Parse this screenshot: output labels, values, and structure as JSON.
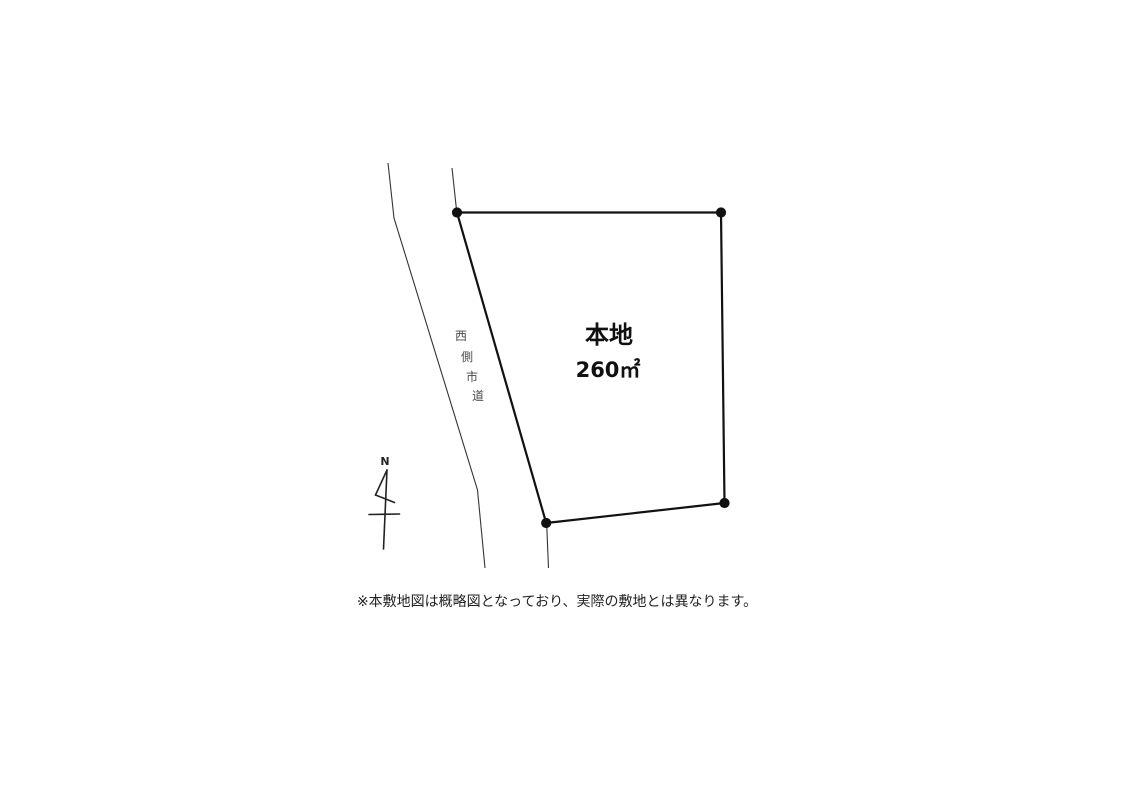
{
  "canvas": {
    "width": 1124,
    "height": 793,
    "background": "#ffffff"
  },
  "plot": {
    "label": "本地",
    "area": "260㎡",
    "polygon_points": "457,212.5 721,212.5 724.5,503 546.2,523",
    "vertices": [
      {
        "x": 457,
        "y": 212.5
      },
      {
        "x": 721,
        "y": 212.5
      },
      {
        "x": 724.5,
        "y": 503
      },
      {
        "x": 546.2,
        "y": 523
      }
    ],
    "stroke_color": "#111111"
  },
  "road": {
    "label": "西側市道",
    "label_chars": [
      "西",
      "側",
      "市",
      "道"
    ],
    "left_edge_points": "388,163 394,218 477.5,490 485,568",
    "right_edge_upper_points": "452,168 456.8,212.5",
    "right_edge_lower_points": "546.8,527 548.5,568",
    "stroke_color": "#333333"
  },
  "north_arrow": {
    "label": "N"
  },
  "disclaimer": "※本敷地図は概略図となっており、実際の敷地とは異なります。"
}
